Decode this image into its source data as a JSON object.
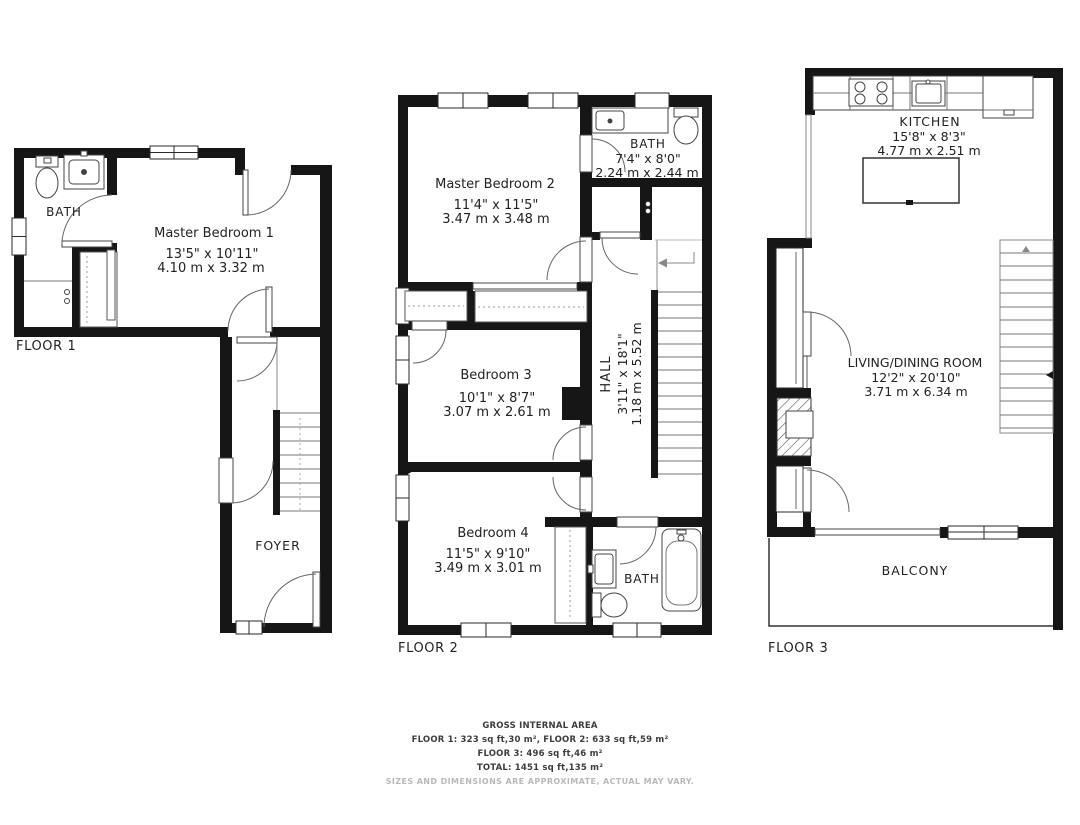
{
  "floor1": {
    "label": "FLOOR 1",
    "bath": {
      "name": "BATH"
    },
    "master_bedroom_1": {
      "name": "Master Bedroom 1",
      "size_imperial": "13'5\" x 10'11\"",
      "size_metric": "4.10 m x 3.32 m"
    },
    "foyer": {
      "name": "FOYER"
    }
  },
  "floor2": {
    "label": "FLOOR 2",
    "master_bedroom_2": {
      "name": "Master Bedroom 2",
      "size_imperial": "11'4\" x 11'5\"",
      "size_metric": "3.47 m x 3.48 m"
    },
    "bath_upper": {
      "name": "BATH",
      "size_imperial": "7'4\" x 8'0\"",
      "size_metric": "2.24 m x 2.44 m"
    },
    "bedroom_3": {
      "name": "Bedroom 3",
      "size_imperial": "10'1\" x 8'7\"",
      "size_metric": "3.07 m x 2.61 m"
    },
    "hall": {
      "name": "HALL",
      "size_imperial": "3'11\" x 18'1\"",
      "size_metric": "1.18 m x 5.52 m"
    },
    "bedroom_4": {
      "name": "Bedroom 4",
      "size_imperial": "11'5\" x 9'10\"",
      "size_metric": "3.49 m x 3.01 m"
    },
    "bath_lower": {
      "name": "BATH"
    }
  },
  "floor3": {
    "label": "FLOOR 3",
    "kitchen": {
      "name": "KITCHEN",
      "size_imperial": "15'8\" x 8'3\"",
      "size_metric": "4.77 m x 2.51 m"
    },
    "living_dining": {
      "name": "LIVING/DINING ROOM",
      "size_imperial": "12'2\" x 20'10\"",
      "size_metric": "3.71 m x 6.34 m"
    },
    "balcony": {
      "name": "BALCONY"
    }
  },
  "fixtures": {
    "floor1": [
      "toilet",
      "sink",
      "shower-control",
      "wardrobe",
      "stairs"
    ],
    "floor2": [
      "sink",
      "toilet",
      "vanity",
      "bathtub",
      "stairs",
      "wardrobes",
      "closet"
    ],
    "floor3": [
      "stove",
      "kitchen-sink",
      "refrigerator",
      "island",
      "stairs",
      "fireplace-flue"
    ]
  },
  "footer": {
    "title": "GROSS INTERNAL AREA",
    "floors_1_2": "FLOOR 1: 323 sq ft,30 m², FLOOR 2: 633 sq ft,59 m²",
    "floor_3": "FLOOR 3: 496 sq ft,46 m²",
    "total": "TOTAL: 1451 sq ft,135 m²",
    "disclaimer": "SIZES AND DIMENSIONS ARE APPROXIMATE, ACTUAL MAY VARY."
  },
  "colors": {
    "wall": "#161616",
    "line": "#444444",
    "text": "#222222",
    "muted": "#b9b9b9"
  }
}
